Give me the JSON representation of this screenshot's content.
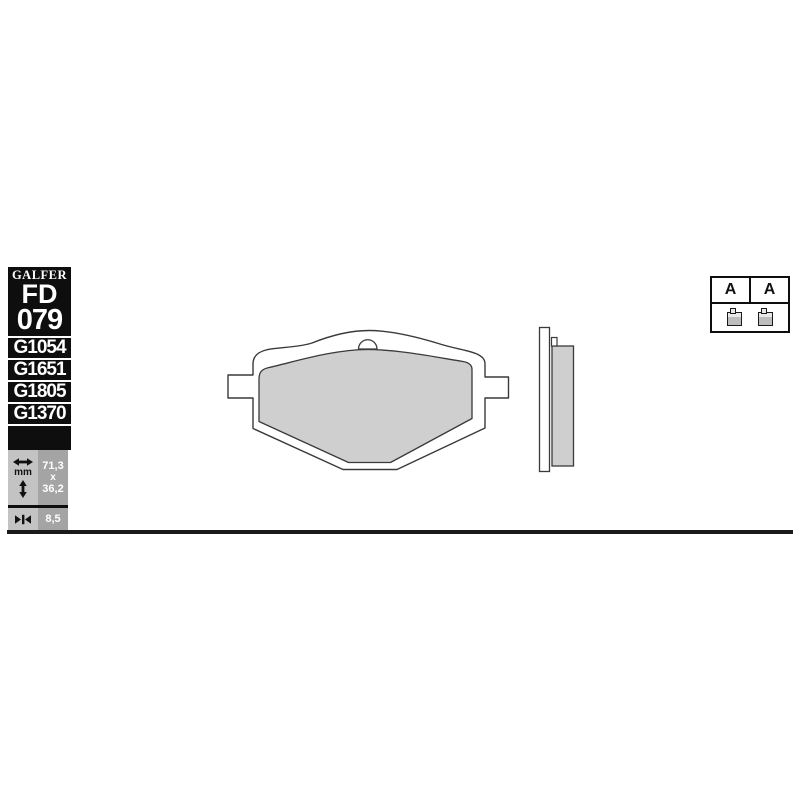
{
  "sidebar": {
    "brand": "GALFER",
    "model_prefix": "FD",
    "model_number": "079",
    "compound_codes": [
      "G1054",
      "G1651",
      "G1805",
      "G1370"
    ],
    "dimensions": {
      "unit": "mm",
      "width": "71,3",
      "separator": "x",
      "height": "36,2",
      "thickness": "8,5"
    }
  },
  "compound_table": {
    "cells": [
      {
        "label": "A"
      },
      {
        "label": "A"
      }
    ]
  },
  "drawing": {
    "views": [
      "front",
      "side"
    ]
  },
  "colors": {
    "sidebar_bg": "#0e0e0e",
    "cell_light_bg": "#c3c3c3",
    "cell_dark_bg": "#a4a4a4",
    "pad_fill": "#cfcfcf",
    "outline": "#3a3a3a",
    "text_on_dark": "#ffffff"
  }
}
